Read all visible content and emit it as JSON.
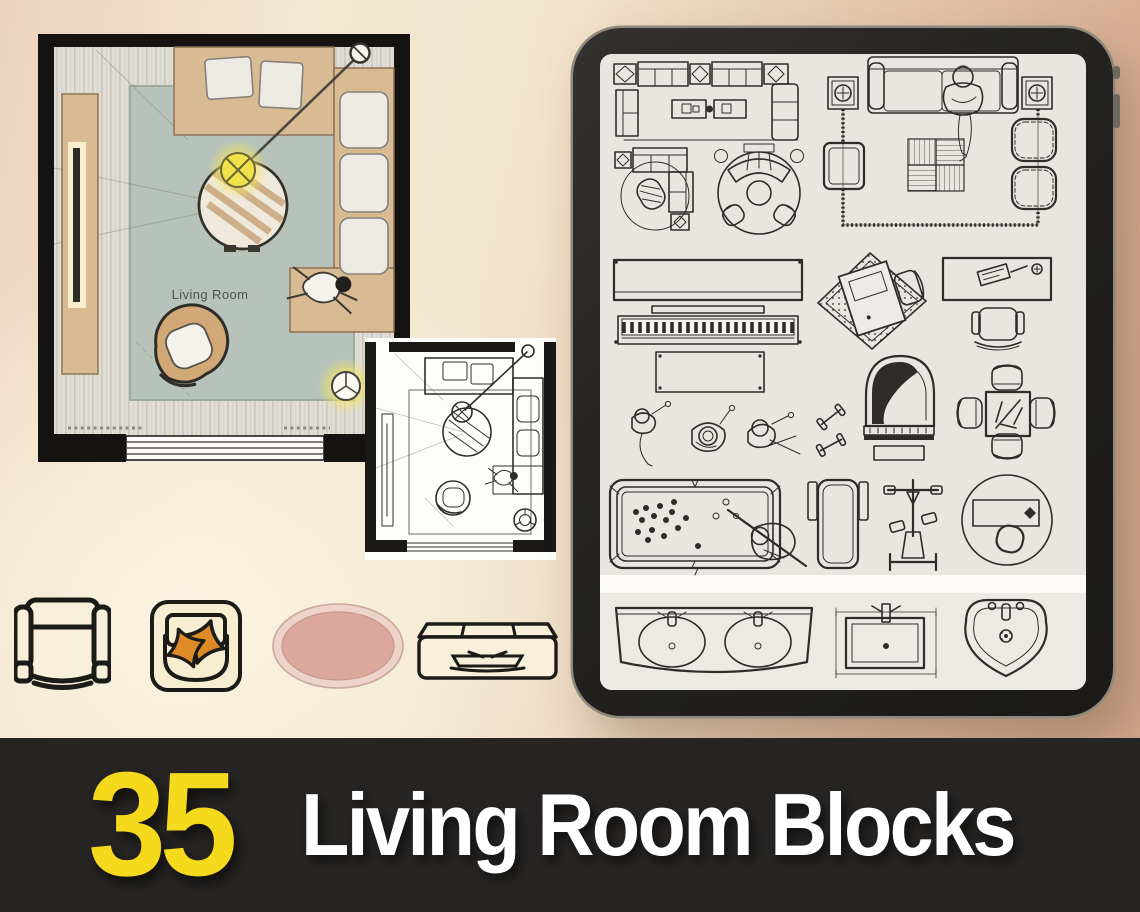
{
  "background": {
    "gradient_left": "#f3e7cf",
    "gradient_right": "#cfa68c",
    "top_left_tint": "#ecd2bc"
  },
  "banner": {
    "count": "35",
    "title": "Living Room Blocks",
    "count_color": "#f5d91d",
    "title_color": "#ffffff",
    "background": "#272523"
  },
  "floor_plan": {
    "room_label": "Living Room",
    "wall_color": "#141311",
    "rug_color": "#b7c3ba",
    "furniture_color": "#d9bb93",
    "lamp_glow_color": "#f0e24a",
    "floor_color": "#e0ddd6"
  },
  "sketch_plan": {
    "style": "line-drawing",
    "paper_color": "#fdfdfa",
    "line_color": "#2f2d2a"
  },
  "tablet": {
    "frame_color": "#22211f",
    "rim_color": "#8f897b",
    "screen_color": "#e9e6e1",
    "line_color": "#2f2d2a",
    "blocks": [
      "sofa-conversation-set",
      "sectional-sofa-round-rug",
      "curved-sofa-round-rug",
      "sofa-lounge-set-with-person",
      "upright-piano-with-bench",
      "people-top-view",
      "desk-on-diagonal-rug",
      "writing-desk-with-chair",
      "dumbbells",
      "grand-piano",
      "game-table-with-chairs",
      "pool-table-with-player",
      "treadmill",
      "exercise-bike",
      "round-rug-with-desk",
      "double-sink-vanity",
      "wall-mounted-sink",
      "pedestal-sink"
    ]
  },
  "icon_row": {
    "items": [
      "armchair-top-view",
      "lounge-chair-with-pillows",
      "oval-rug",
      "sofa-console-top-view"
    ],
    "fill_color": "#f8f0da",
    "outline_color": "#1b1b18",
    "pillow_color": "#de8b27",
    "rug_fill": "#dba89b",
    "rug_ring": "#eed3cb"
  }
}
